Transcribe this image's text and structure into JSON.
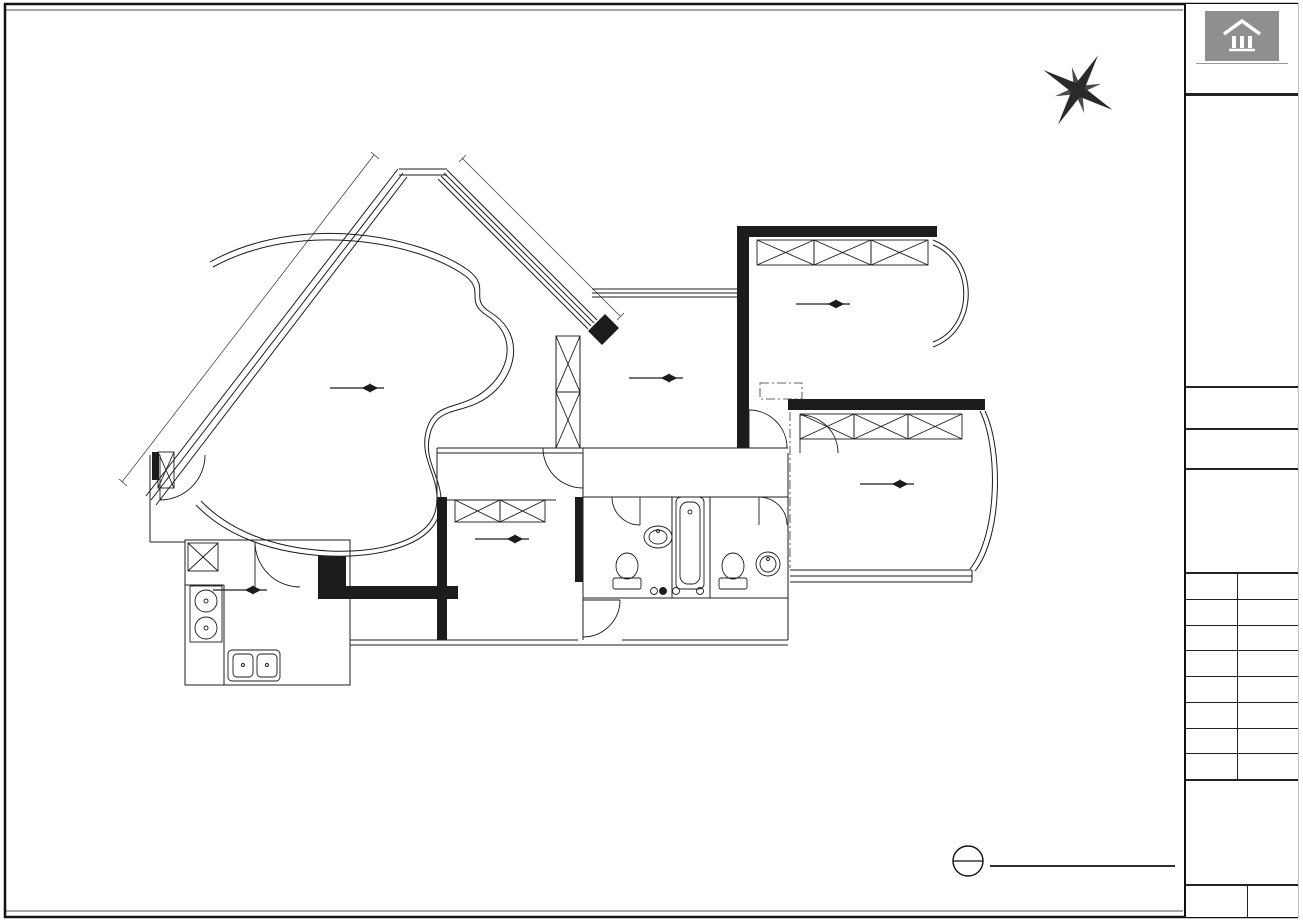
{
  "banner": {
    "pre": "由",
    "brand": "Autodesk",
    "post": "教育版产品制作"
  },
  "titleblock": {
    "brand": "星艺装饰",
    "brand_reg": "®",
    "brand_en": "XINGYI DECORATION",
    "project_label": "项目名称:",
    "project_label_en": "PROJECT TITLE",
    "project_name": "帝景苑帝庭轩19G房",
    "drawing_label": "图 名:",
    "drawing_label_en": "DRAWING TITLE",
    "drawing_title": "原建筑平面图",
    "permit_line1": "施工图审查许可证编号:",
    "permit_line2": "A144016621(甲级)",
    "firm_label": "设计单位:",
    "firm_label_en": "DESIGN FIRM",
    "firm_name": "广东星艺装饰集团股份有限公司",
    "firm_addr1": "总部地址:广州市天河体育东路116号",
    "firm_addr2": "财富广场东塔十楼",
    "firm_phone": "客户服务电话:020-38818321(10条线)",
    "firm_web": "http://www.xingyigz.com.cn",
    "rows": [
      {
        "label": "客户签名:",
        "label_en": "CUSTOMER SIGNATURE BY",
        "value": ""
      },
      {
        "label": "项目负责:",
        "label_en": "APPROVED PROJECT BY",
        "value": ""
      },
      {
        "label": "审 核:",
        "label_en": "APPROVED BY",
        "value": "张 磊"
      },
      {
        "label": "设 计:",
        "label_en": "DESIGN BY",
        "value": "潘 杨"
      },
      {
        "label": "绘 图:",
        "label_en": "DRAWING BY",
        "value": "张国权"
      },
      {
        "label": "比 例:",
        "label_en": "SCALE",
        "value": "A3 1:75"
      },
      {
        "label": "图 号:",
        "label_en": "DRAWING No",
        "value": "P-01"
      },
      {
        "label": "报价:",
        "label_en": "Cost Engineer",
        "value": ""
      }
    ],
    "notes_label": "备注:",
    "notes": [
      "1.如果尺寸与现场不符，以现场尺寸为准.",
      "2.施工单位有责任在现场核实所有尺寸.",
      "有发现严重不符之处应通知设计师修改设计",
      "3.本套图纸之版权属广东星艺装饰集团股份",
      "有限公司所有.图纸仅作本工程施工之用.",
      "未经广东星艺装饰集团股份有限公司",
      "书面授权.任何他人不得以任何方式复制",
      "本套图纸之任何部分.亦不得将本套图纸",
      "用于其他任何用途."
    ],
    "date_label": "日 期:2020.7",
    "date_en": "DATE",
    "serial_label": "顺序号:",
    "serial_en": "NO.",
    "serial_value": "01"
  },
  "plan": {
    "chains": [
      {
        "d": "h",
        "y": 183,
        "x0": 570,
        "x1": 1000,
        "vals": [
          9670
        ]
      },
      {
        "d": "h",
        "y": 197,
        "x0": 570,
        "x1": 1000,
        "vals": [
          3820,
          220,
          3640,
          600,
          1390
        ]
      },
      {
        "d": "h",
        "y": 709,
        "x0": 185,
        "x1": 1030,
        "vals": [
          2310,
          840,
          1130,
          1080,
          930,
          830,
          1050,
          950,
          580,
          600,
          820,
          820,
          980,
          4230,
          360
        ]
      },
      {
        "d": "h",
        "y": 722,
        "x0": 185,
        "x1": 1030,
        "vals": [
          2310,
          260,
          3050,
          270,
          2810,
          250,
          2130,
          150,
          2620,
          150,
          4590
        ]
      },
      {
        "d": "h",
        "y": 734,
        "x0": 185,
        "x1": 1030,
        "vals": [
          18590
        ]
      },
      {
        "d": "v",
        "x": 1022,
        "y0": 225,
        "y1": 640,
        "vals": [
          3720,
          300,
          780,
          150,
          1020,
          150,
          1720,
          280,
          890
        ]
      },
      {
        "d": "v",
        "x": 1040,
        "y0": 225,
        "y1": 640,
        "vals": [
          3720,
          3820,
          890
        ]
      },
      {
        "d": "v",
        "x": 1058,
        "y0": 225,
        "y1": 640,
        "vals": [
          9010
        ]
      },
      {
        "d": "v",
        "x": 145,
        "y0": 452,
        "y1": 582,
        "vals": [
          1450
        ]
      },
      {
        "d": "v",
        "x": 162,
        "y0": 540,
        "y1": 685,
        "vals": [
          2880
        ]
      }
    ],
    "texts": [
      {
        "t": "9370",
        "x": 256,
        "y": 318,
        "r": -52
      },
      {
        "t": "4250",
        "x": 530,
        "y": 230,
        "r": 45
      },
      {
        "t": "DH-300",
        "x": 490,
        "y": 258,
        "r": 45,
        "s": 8.5
      },
      {
        "t": "CH-2000",
        "x": 499,
        "y": 270,
        "r": 45,
        "s": 8.5
      },
      {
        "t": "DH-370",
        "x": 677,
        "y": 304,
        "s": 9
      },
      {
        "t": "CH-2030",
        "x": 677,
        "y": 314,
        "s": 9
      },
      {
        "t": "+2.750",
        "x": 656,
        "y": 374,
        "w": 1
      },
      {
        "t": "-0.000",
        "x": 656,
        "y": 392
      },
      {
        "t": "原有木地板,四周",
        "x": 630,
        "y": 404,
        "s": 8,
        "a": "start",
        "i": 1
      },
      {
        "t": "石膏线,柜子",
        "x": 630,
        "y": 415,
        "s": 8,
        "a": "start",
        "i": 1
      },
      {
        "t": "+2.750",
        "x": 823,
        "y": 300,
        "w": 1
      },
      {
        "t": "-0.000",
        "x": 823,
        "y": 317
      },
      {
        "t": "原有木地板,四周石膏线",
        "x": 803,
        "y": 334,
        "s": 8,
        "a": "start",
        "i": 1
      },
      {
        "t": "衣柜",
        "x": 803,
        "y": 346,
        "s": 8,
        "a": "start",
        "i": 1
      },
      {
        "t": "DH-370",
        "x": 917,
        "y": 341,
        "s": 9
      },
      {
        "t": "CH-2030",
        "x": 917,
        "y": 352,
        "s": 9
      },
      {
        "t": "LH-300",
        "x": 783,
        "y": 377,
        "s": 9,
        "a": "start"
      },
      {
        "t": "LW-300",
        "x": 783,
        "y": 388,
        "s": 9,
        "a": "start"
      },
      {
        "t": "+2.700",
        "x": 357,
        "y": 383,
        "w": 1
      },
      {
        "t": "-0.000",
        "x": 357,
        "y": 401
      },
      {
        "t": "原有木地板,天花,柜子",
        "x": 312,
        "y": 427,
        "s": 8,
        "a": "start",
        "i": 1
      },
      {
        "t": "四周石膏线",
        "x": 312,
        "y": 439,
        "s": 8,
        "a": "start",
        "i": 1
      },
      {
        "t": "原有木地板,天花",
        "x": 604,
        "y": 470,
        "s": 8,
        "a": "start",
        "i": 1
      },
      {
        "t": "四周石膏线",
        "x": 600,
        "y": 482,
        "s": 8,
        "a": "start",
        "i": 1
      },
      {
        "t": "原有地砖,天",
        "x": 604,
        "y": 528,
        "s": 8,
        "a": "start",
        "i": 1
      },
      {
        "t": "花,洁具,墙砖",
        "x": 604,
        "y": 540,
        "s": 8,
        "a": "start",
        "i": 1
      },
      {
        "t": "原有地砖,天",
        "x": 720,
        "y": 520,
        "s": 8,
        "a": "start",
        "i": 1
      },
      {
        "t": "花,洁具,墙",
        "x": 718,
        "y": 532,
        "s": 8,
        "a": "start",
        "i": 1
      },
      {
        "t": "砖,浴缸",
        "x": 715,
        "y": 544,
        "s": 8,
        "a": "start",
        "i": 1
      },
      {
        "t": "原有地砖,墙砖",
        "x": 628,
        "y": 606,
        "s": 8,
        "a": "start",
        "i": 1
      },
      {
        "t": "DH-900",
        "x": 733,
        "y": 599,
        "s": 9
      },
      {
        "t": "CH-1460",
        "x": 733,
        "y": 610,
        "s": 9
      },
      {
        "t": "+2.700",
        "x": 502,
        "y": 534,
        "w": 1
      },
      {
        "t": "-0.000",
        "x": 502,
        "y": 551
      },
      {
        "t": "原有木地板,石膏线",
        "x": 482,
        "y": 567,
        "s": 8,
        "a": "start",
        "i": 1
      },
      {
        "t": "吊柜",
        "x": 482,
        "y": 579,
        "s": 8,
        "a": "start",
        "i": 1
      },
      {
        "t": "DH-860",
        "x": 505,
        "y": 611,
        "s": 9
      },
      {
        "t": "CH-1540",
        "x": 505,
        "y": 622,
        "s": 9
      },
      {
        "t": "+2.360",
        "x": 240,
        "y": 585,
        "w": 1
      },
      {
        "t": "-0.020",
        "x": 240,
        "y": 602
      },
      {
        "t": "原有地砖,天花,橱柜,",
        "x": 218,
        "y": 617,
        "s": 8,
        "a": "start",
        "i": 1
      },
      {
        "t": "墙砖",
        "x": 218,
        "y": 629,
        "s": 8,
        "a": "start",
        "i": 1
      },
      {
        "t": "DH-860",
        "x": 316,
        "y": 607,
        "s": 9
      },
      {
        "t": "CH-1540",
        "x": 316,
        "y": 618,
        "s": 9
      },
      {
        "t": "DH-860",
        "x": 320,
        "y": 653,
        "s": 9
      },
      {
        "t": "CH-1520",
        "x": 320,
        "y": 664,
        "s": 9
      },
      {
        "t": "LH-490",
        "x": 798,
        "y": 484,
        "s": 9,
        "a": "start"
      },
      {
        "t": "LW-100",
        "x": 798,
        "y": 495,
        "s": 9,
        "a": "start"
      },
      {
        "t": "+2.750",
        "x": 887,
        "y": 479,
        "w": 1
      },
      {
        "t": "-0.000",
        "x": 887,
        "y": 496
      },
      {
        "t": "DH-370",
        "x": 975,
        "y": 485,
        "s": 9
      },
      {
        "t": "CH-2030",
        "x": 975,
        "y": 496,
        "s": 9
      },
      {
        "t": "原有木地板,四周石膏线",
        "x": 872,
        "y": 520,
        "s": 8,
        "a": "start",
        "i": 1
      },
      {
        "t": "衣柜",
        "x": 872,
        "y": 532,
        "s": 8,
        "a": "start",
        "i": 1
      },
      {
        "t": "E",
        "x": 1091,
        "y": 54,
        "s": 11,
        "r": 35
      },
      {
        "t": "N",
        "x": 1041,
        "y": 76,
        "s": 11,
        "r": -35
      },
      {
        "t": "S",
        "x": 1116,
        "y": 108,
        "s": 11,
        "r": -35
      },
      {
        "t": "W",
        "x": 1068,
        "y": 127,
        "s": 11,
        "r": 35
      },
      {
        "t": "1",
        "x": 968,
        "y": 858,
        "s": 12,
        "w": 1
      },
      {
        "t": "PLAN",
        "x": 968,
        "y": 872,
        "s": 6
      },
      {
        "t": "PLAN",
        "x": 997,
        "y": 862,
        "s": 15,
        "w": 1,
        "a": "start"
      },
      {
        "t": "Scale 1:60",
        "x": 997,
        "y": 879,
        "s": 10.5,
        "w": 1,
        "a": "start"
      },
      {
        "t": "原建筑平面图",
        "x": 1063,
        "y": 861,
        "s": 14,
        "a": "start"
      }
    ]
  }
}
